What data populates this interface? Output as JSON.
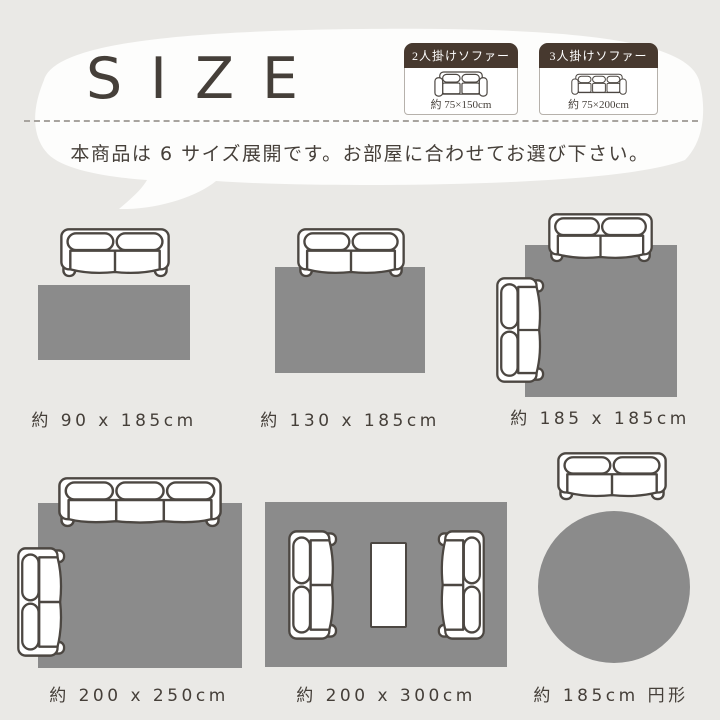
{
  "title": "SIZE",
  "description": "本商品は 6 サイズ展開です。お部屋に合わせてお選び下さい。",
  "legend": [
    {
      "title": "2人掛けソファー",
      "size": "約 75×150cm",
      "seats": 2,
      "icon": "sofa-2seat-front-icon"
    },
    {
      "title": "3人掛けソファー",
      "size": "約 75×200cm",
      "seats": 3,
      "icon": "sofa-3seat-front-icon"
    }
  ],
  "diagrams": [
    {
      "label": "約 90 x 185cm",
      "rug_shape": "rectangle"
    },
    {
      "label": "約 130 x 185cm",
      "rug_shape": "rectangle"
    },
    {
      "label": "約 185 x 185cm",
      "rug_shape": "square"
    },
    {
      "label": "約 200 x 250cm",
      "rug_shape": "rectangle"
    },
    {
      "label": "約 200 x 300cm",
      "rug_shape": "rectangle"
    },
    {
      "label": "約 185cm 円形",
      "rug_shape": "circle"
    }
  ],
  "colors": {
    "background": "#eae9e6",
    "bubble": "#fdfdfc",
    "rug": "#8b8b8b",
    "line": "#4c4742",
    "text": "#453f39",
    "dash": "#a8a49f",
    "legend_header_bg": "#47392f",
    "legend_header_text": "#ffffff"
  }
}
